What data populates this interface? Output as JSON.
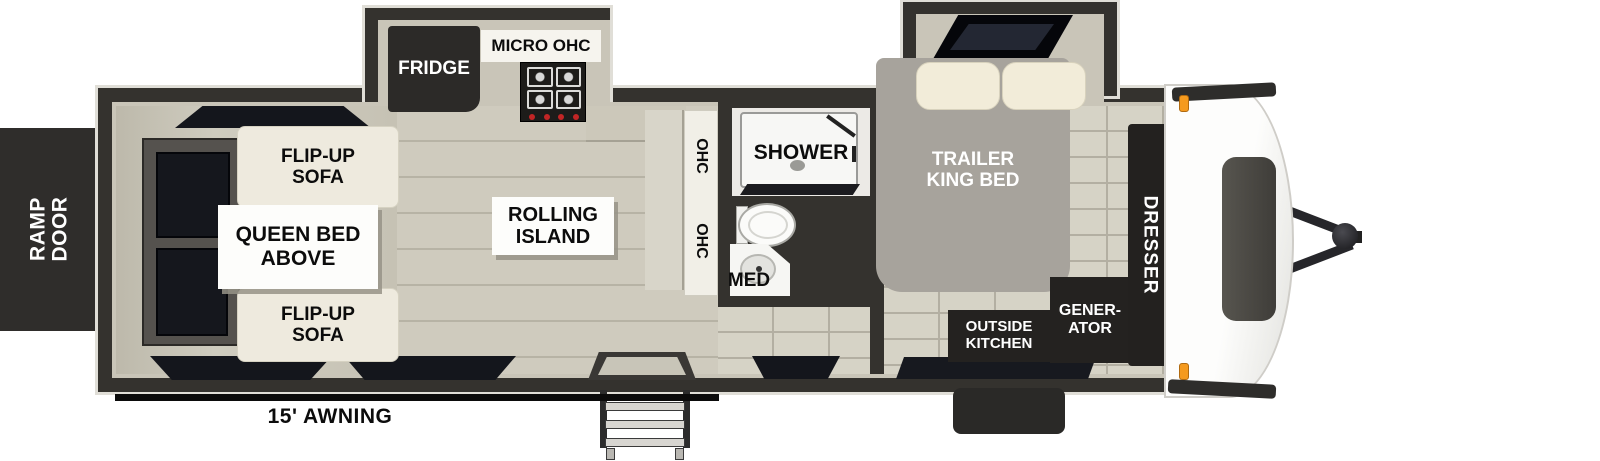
{
  "title": "Travel trailer floorplan with rear ramp door",
  "labels": {
    "ramp_door": "RAMP\nDOOR",
    "flip_up_sofa_top": "FLIP-UP\nSOFA",
    "queen_bed_above": "QUEEN BED\nABOVE",
    "flip_up_sofa_bottom": "FLIP-UP\nSOFA",
    "fridge": "FRIDGE",
    "micro_ohc": "MICRO OHC",
    "rolling_island": "ROLLING\nISLAND",
    "ohc_upper": "OHC",
    "ohc_lower": "OHC",
    "shower": "SHOWER",
    "med": "MED",
    "trailer_king_bed": "TRAILER\nKING BED",
    "dresser": "DRESSER",
    "outside_kitchen": "OUTSIDE\nKITCHEN",
    "generator": "GENER-\nATOR",
    "awning": "15' AWNING"
  },
  "colors": {
    "wall": "#34322e",
    "interior_trim": "#c9c5b8",
    "garage_floor": "#c6c2b4",
    "wood_floor": "#cdc9bc",
    "bedroom_floor": "#d6d3c6",
    "dark_fixture": "#242220",
    "window": "#15171d",
    "sofa_cream": "#eeeade",
    "bed_gray": "#a7a39c",
    "marker_light_orange": "#f59a1e",
    "awning_black": "#0b0b0b",
    "label_text": "#0c0c0c"
  }
}
